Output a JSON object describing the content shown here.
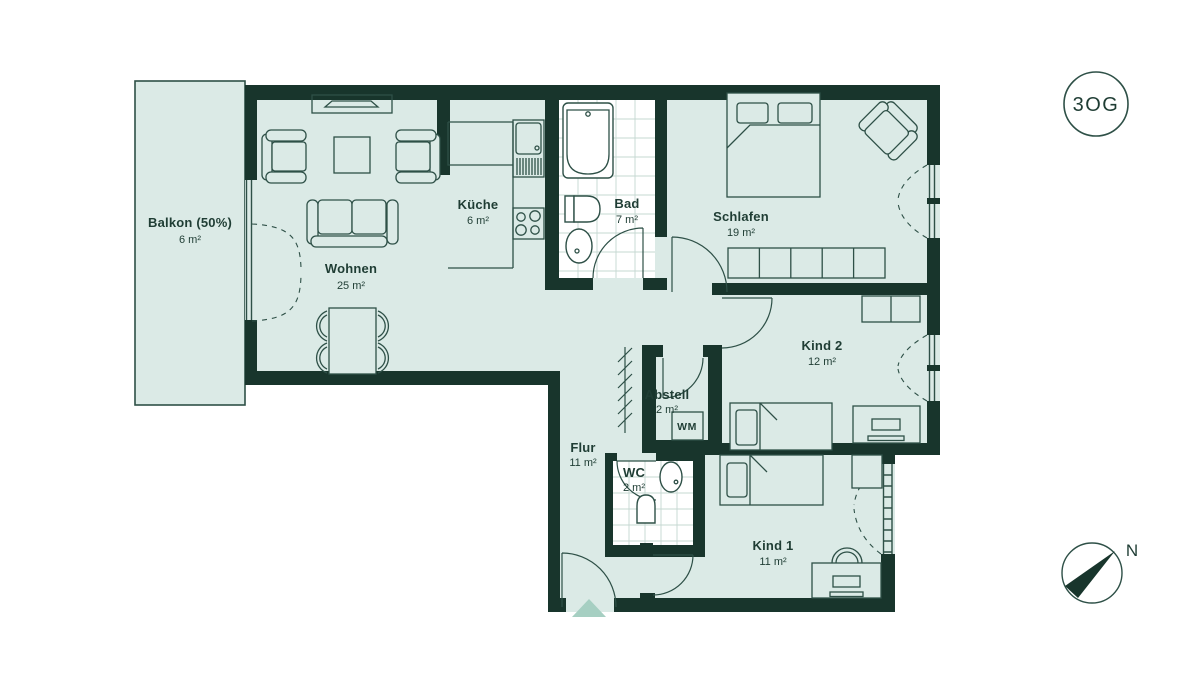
{
  "floor_badge": "3OG",
  "compass_label": "N",
  "appliances": {
    "washing_machine": "WM"
  },
  "colors": {
    "wall": "#18352c",
    "floor": "#dbeae6",
    "line": "#2e5047",
    "accent": "#a6cfc2",
    "text": "#1f3d34",
    "tile_line": "#c5d8d1",
    "background": "#ffffff"
  },
  "rooms": [
    {
      "name": "Balkon (50%)",
      "area": "6 m²"
    },
    {
      "name": "Wohnen",
      "area": "25 m²"
    },
    {
      "name": "Küche",
      "area": "6 m²"
    },
    {
      "name": "Bad",
      "area": "7 m²"
    },
    {
      "name": "Schlafen",
      "area": "19 m²"
    },
    {
      "name": "Kind 2",
      "area": "12 m²"
    },
    {
      "name": "Abstell",
      "area": "2 m²"
    },
    {
      "name": "Flur",
      "area": "11 m²"
    },
    {
      "name": "WC",
      "area": "2 m²"
    },
    {
      "name": "Kind 1",
      "area": "11 m²"
    }
  ]
}
